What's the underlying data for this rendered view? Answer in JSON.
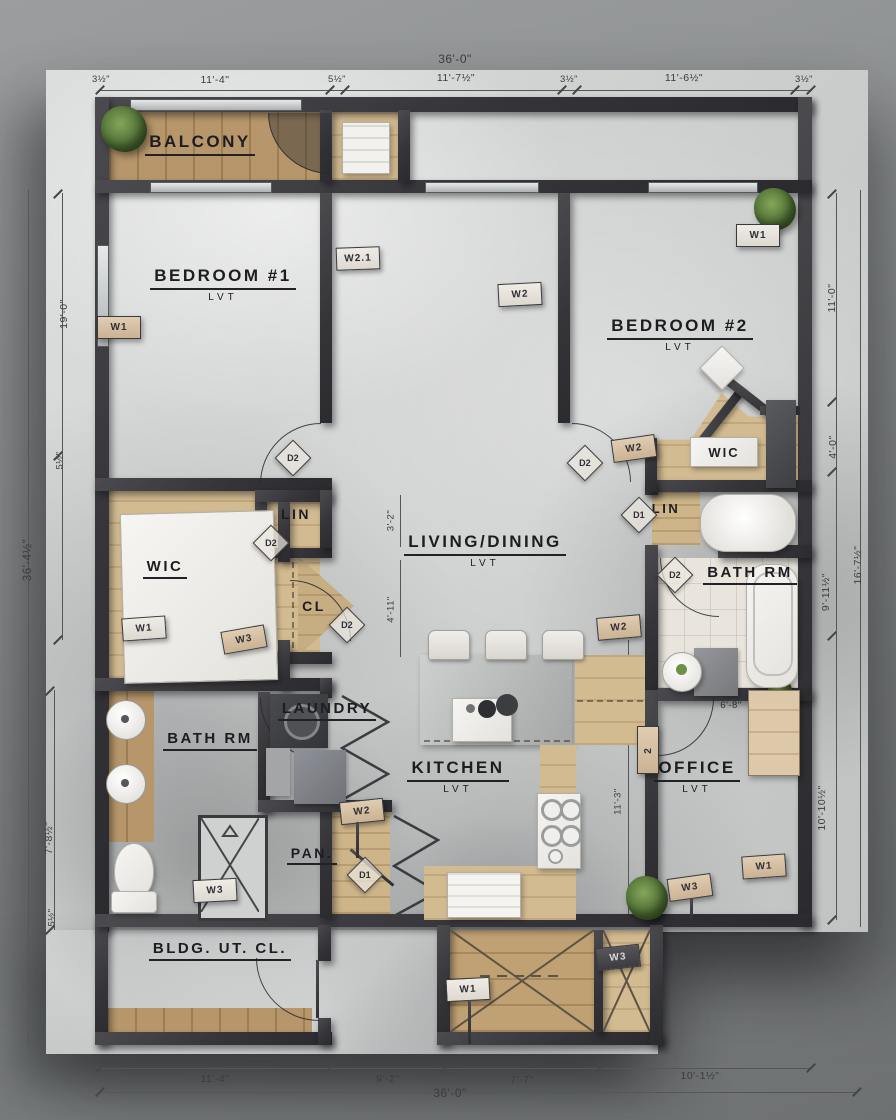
{
  "rooms": [
    {
      "name": "BALCONY",
      "floor": ""
    },
    {
      "name": "BEDROOM #1",
      "floor": "LVT"
    },
    {
      "name": "BEDROOM #2",
      "floor": "LVT"
    },
    {
      "name": "LIVING/DINING",
      "floor": "LVT"
    },
    {
      "name": "WIC",
      "floor": ""
    },
    {
      "name": "LIN",
      "floor": ""
    },
    {
      "name": "CL",
      "floor": ""
    },
    {
      "name": "WIC",
      "floor": ""
    },
    {
      "name": "LIN",
      "floor": ""
    },
    {
      "name": "BATH RM",
      "floor": ""
    },
    {
      "name": "BATH RM",
      "floor": ""
    },
    {
      "name": "LAUNDRY",
      "floor": ""
    },
    {
      "name": "KITCHEN",
      "floor": "LVT"
    },
    {
      "name": "OFFICE",
      "floor": "LVT"
    },
    {
      "name": "PAN.",
      "floor": ""
    },
    {
      "name": "BLDG. UT. CL.",
      "floor": ""
    }
  ],
  "dims": {
    "top_overall": "36'-0\"",
    "top": [
      "3½\"",
      "11'-4\"",
      "5½\"",
      "11'-7½\"",
      "3½\"",
      "11'-6½\"",
      "3½\""
    ],
    "bottom": [
      "11'-4\"",
      "9'-2\"",
      "7'-7\"",
      "10'-1½\""
    ],
    "bottom_overall": "36'-0\"",
    "left": [
      "19'-0\"",
      "5½\"",
      "7'-8½\"",
      "5½\""
    ],
    "left_overall": "36'-4½\"",
    "right": [
      "11'-0\"",
      "4'-0\"",
      "16'-7½\"",
      "9'-11½\"",
      "10'-10½\""
    ],
    "interior": [
      "4'-6\"",
      "3'-2\"",
      "4'-11\"",
      "6'-8\"",
      "1'-3\"",
      "6'-8\"",
      "11'-3\""
    ]
  },
  "tags": [
    "W1",
    "W2.1",
    "W2",
    "W1",
    "W2",
    "W1",
    "W3",
    "W2",
    "W3",
    "W2",
    "2",
    "W1",
    "W3",
    "W1",
    "W3"
  ],
  "doors": [
    "D2",
    "D2",
    "D2",
    "D2",
    "D1",
    "D2",
    "D1"
  ]
}
